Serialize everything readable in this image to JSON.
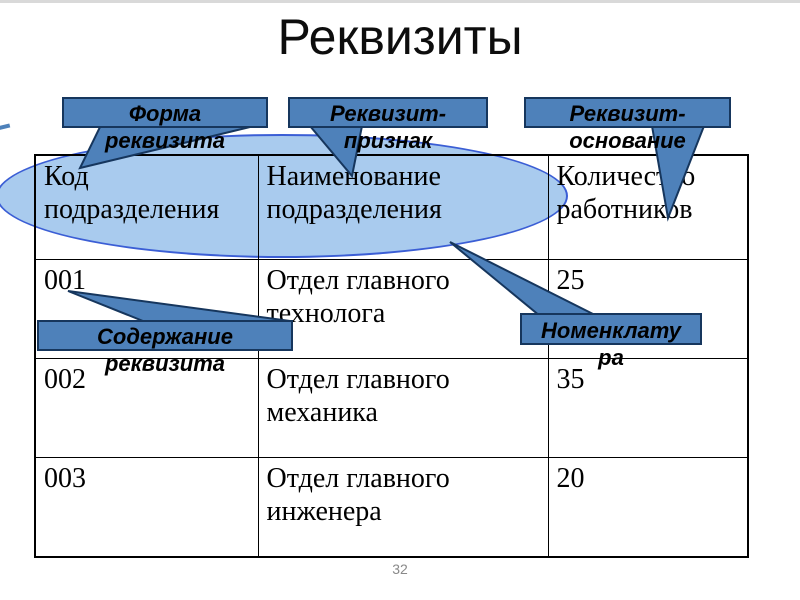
{
  "title": "Реквизиты",
  "page_number": "32",
  "colors": {
    "callout_fill": "#4e81ba",
    "callout_border": "#16365d",
    "ellipse_fill": "#a9cbee",
    "ellipse_border": "#3b5ed5",
    "table_border": "#000000",
    "title_color": "#0d0d0d",
    "page_number_color": "#898989"
  },
  "callouts": {
    "form": {
      "label": "Форма реквизита",
      "lines": [
        "Форма",
        "реквизита"
      ]
    },
    "feature": {
      "label": "Реквизит-признак",
      "lines": [
        "Реквизит-",
        "признак"
      ]
    },
    "base": {
      "label": "Реквизит-основание",
      "lines": [
        "Реквизит-",
        "основание"
      ]
    },
    "content": {
      "label": "Содержание реквизита",
      "lines": [
        "Содержание",
        "реквизита"
      ]
    },
    "nomenclature": {
      "label": "Номенклатура",
      "lines": [
        "Номенклату",
        "ра"
      ]
    }
  },
  "table": {
    "headers": [
      "Код подразделения",
      "Наименование подразделения",
      "Количество работников"
    ],
    "rows": [
      [
        "001",
        "Отдел главного технолога",
        "25"
      ],
      [
        "002",
        "Отдел главного механика",
        "35"
      ],
      [
        "003",
        "Отдел главного инженера",
        "20"
      ]
    ]
  }
}
